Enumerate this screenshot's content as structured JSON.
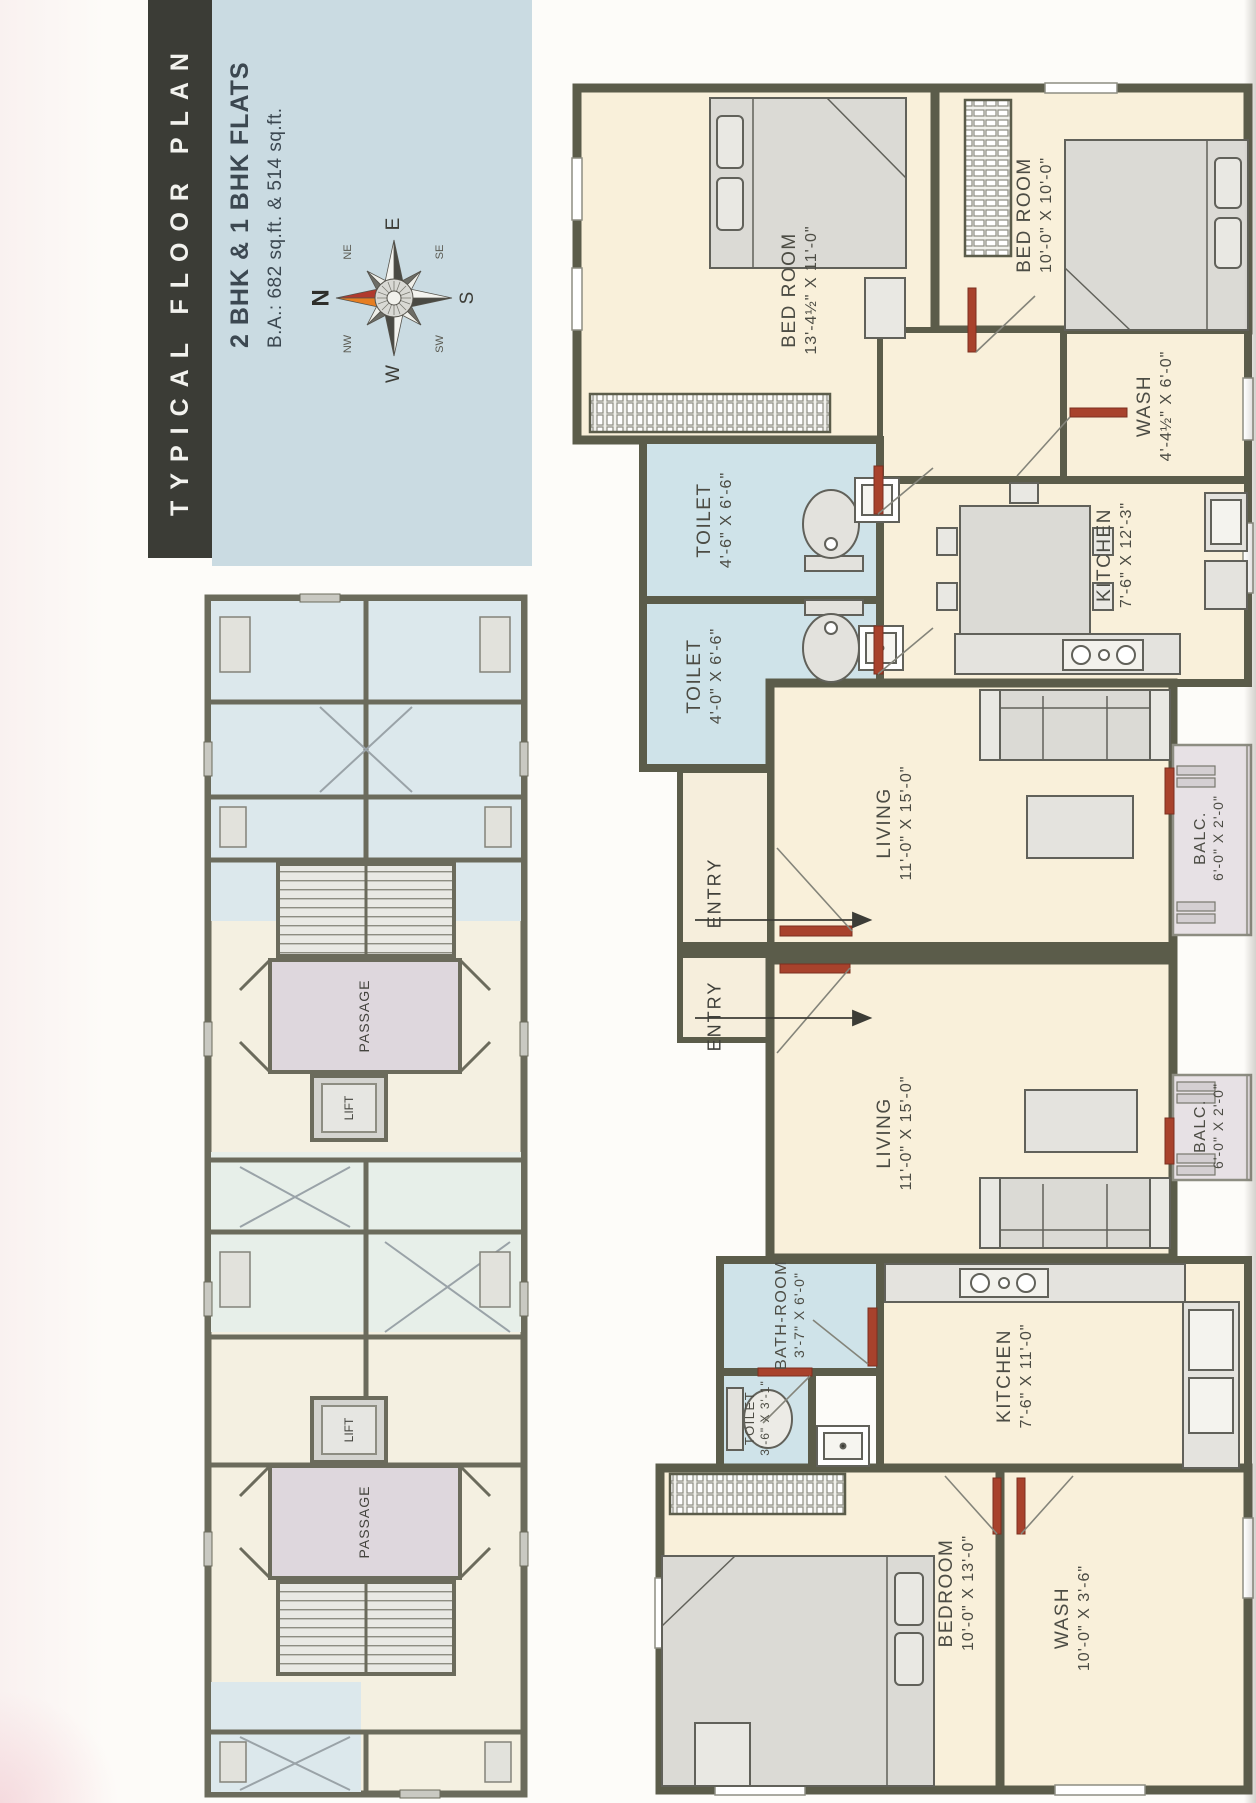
{
  "page": {
    "title": "TYPICAL FLOOR PLAN",
    "subtitle_line1": "2 BHK & 1 BHK FLATS",
    "subtitle_line2": "B.A.: 682 sq.ft. & 514 sq.ft."
  },
  "compass": {
    "n": "N",
    "ne": "NE",
    "e": "E",
    "se": "SE",
    "s": "S",
    "sw": "SW",
    "w": "W",
    "nw": "NW"
  },
  "watermarks": {
    "url_text": "www.A2ZProperty.in",
    "brand_text": "A2ZProperty"
  },
  "key_plan": {
    "passage_label": "PASSAGE",
    "lift_label": "LIFT"
  },
  "floor_plan": {
    "entry_label": "ENTRY",
    "rooms": [
      {
        "name": "BED ROOM",
        "dims": "13'-4½\" X 11'-0\""
      },
      {
        "name": "BED ROOM",
        "dims": "10'-0\" X 10'-0\""
      },
      {
        "name": "WASH",
        "dims": "4'-4½\" X 6'-0\""
      },
      {
        "name": "TOILET",
        "dims": "4'-6\" X 6'-6\""
      },
      {
        "name": "TOILET",
        "dims": "4'-0\" X 6'-6\""
      },
      {
        "name": "KITCHEN",
        "dims": "7'-6\" X 12'-3\""
      },
      {
        "name": "LIVING",
        "dims": "11'-0\" X 15'-0\""
      },
      {
        "name": "BALC.",
        "dims": "6'-0\" X 2'-0\""
      },
      {
        "name": "LIVING",
        "dims": "11'-0\" X 15'-0\""
      },
      {
        "name": "BALC.",
        "dims": "6'-0\" X 2'-0\""
      },
      {
        "name": "BATH-ROOM",
        "dims": "3'-7\" X 6'-0\""
      },
      {
        "name": "TOILET",
        "dims": "3'-6\" X 3'-1\""
      },
      {
        "name": "KITCHEN",
        "dims": "7'-6\" X 11'-0\""
      },
      {
        "name": "BEDROOM",
        "dims": "10'-0\" X 13'-0\""
      },
      {
        "name": "WASH",
        "dims": "10'-0\" X 3'-6\""
      }
    ]
  },
  "colors": {
    "wall": "#5b5c4a",
    "floor": "#f9f0da",
    "wet_room": "#cfe3e9",
    "door_accent": "#a8422c",
    "panel_blue": "#cadbe2",
    "title_bar": "#3b3c36"
  }
}
